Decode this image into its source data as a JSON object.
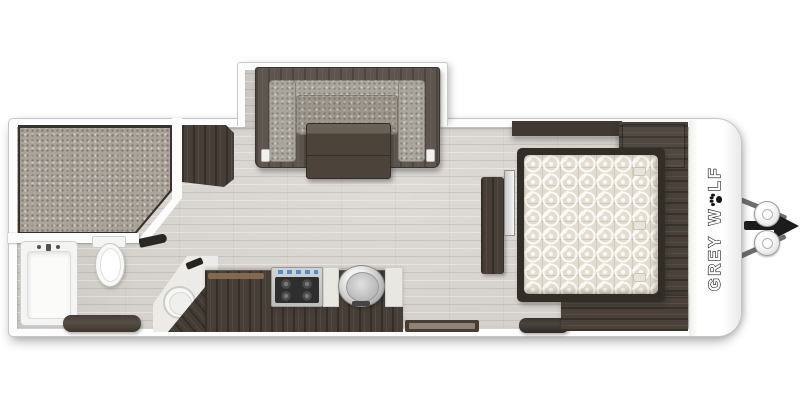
{
  "page": {
    "background_color": "#ffffff",
    "type": "travel-trailer-floor-plan"
  },
  "brand": {
    "word1": "GREY",
    "word2_start": "W",
    "word2_end": "LF",
    "paw_icon": "paw-print-icon",
    "text_color": "#ffffff",
    "outline_color": "#161616"
  },
  "colors": {
    "wall": "#fdfdfd",
    "wall_outline": "#c6c6c6",
    "floor": "#d5d1cc",
    "dark_wood": "#473f37",
    "cushion_gray": "#aba69d",
    "front_mattress_gray": "#aba49b",
    "bed_quilt_cream": "#e3ddd1",
    "stainless": "#c4c4c4",
    "stove_knob_blue": "#4a8fd4",
    "hitch_black": "#1c1c1c",
    "hitch_bar_gray": "#6e6e6e"
  },
  "rooms": {
    "front_bedroom": {
      "items": [
        "bunk-mattress",
        "front-wardrobe"
      ]
    },
    "bathroom": {
      "items": [
        "bathtub",
        "toilet",
        "vanity-bench"
      ]
    },
    "kitchen": {
      "items": [
        "corner-sink",
        "lower-cabinets",
        "cooktop",
        "round-stainless-sink",
        "counter-inserts"
      ]
    },
    "dinette_slide_out": {
      "items": [
        "sofa",
        "dinette-table"
      ]
    },
    "main_bedroom": {
      "items": [
        "bed",
        "overhead-cabinet",
        "wardrobe-top",
        "wardrobe-bottom",
        "tv",
        "tv-console",
        "ottoman"
      ]
    },
    "exterior": {
      "items": [
        "entry-door-mat",
        "a-frame-hitch",
        "propane-tank",
        "propane-tank",
        "brand-lettering"
      ]
    }
  }
}
